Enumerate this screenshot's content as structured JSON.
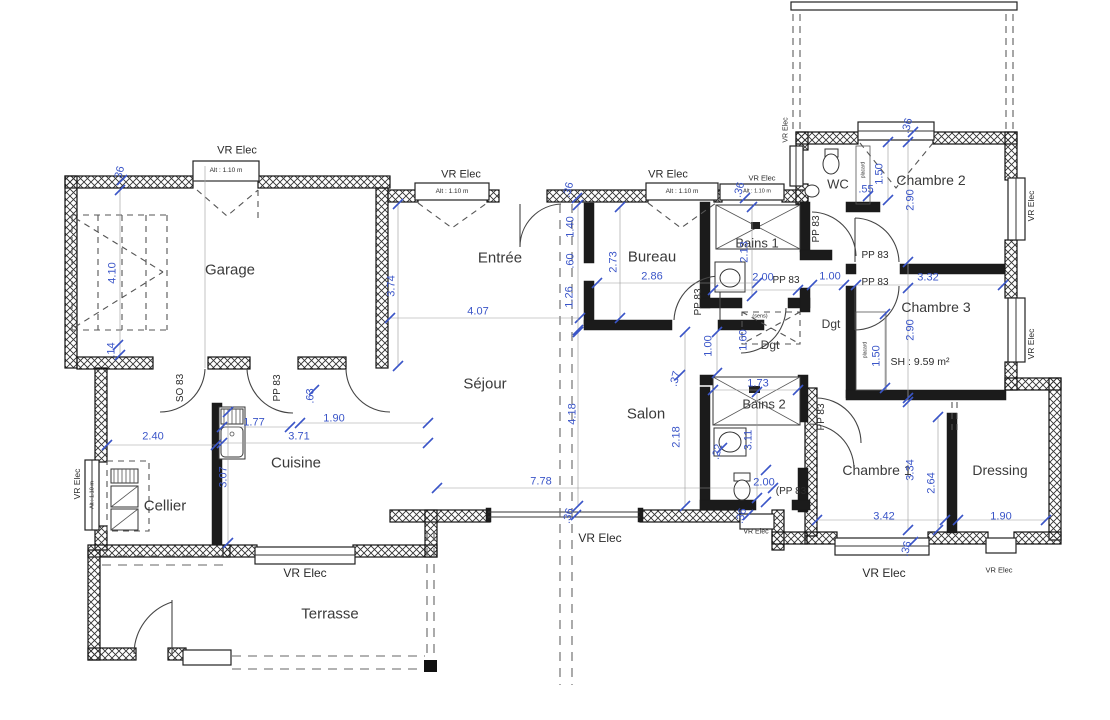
{
  "colors": {
    "dimension": "#3a55c8",
    "wall": "#111111",
    "text": "#3a3a3a",
    "background": "#ffffff"
  },
  "rooms": [
    {
      "label": "Garage",
      "x": 230,
      "y": 270,
      "fs": 15
    },
    {
      "label": "Entrée",
      "x": 500,
      "y": 258,
      "fs": 15
    },
    {
      "label": "Bureau",
      "x": 652,
      "y": 257,
      "fs": 15
    },
    {
      "label": "Séjour",
      "x": 485,
      "y": 384,
      "fs": 15
    },
    {
      "label": "Salon",
      "x": 646,
      "y": 414,
      "fs": 15
    },
    {
      "label": "Cuisine",
      "x": 296,
      "y": 463,
      "fs": 15
    },
    {
      "label": "Cellier",
      "x": 165,
      "y": 506,
      "fs": 15
    },
    {
      "label": "Terrasse",
      "x": 330,
      "y": 614,
      "fs": 15
    },
    {
      "label": "WC",
      "x": 838,
      "y": 184,
      "fs": 13
    },
    {
      "label": "Bains 1",
      "x": 757,
      "y": 243,
      "fs": 13
    },
    {
      "label": "Bains 2",
      "x": 764,
      "y": 404,
      "fs": 13
    },
    {
      "label": "Dgt",
      "x": 770,
      "y": 345,
      "fs": 12
    },
    {
      "label": "Dgt",
      "x": 831,
      "y": 324,
      "fs": 12
    },
    {
      "label": "Chambre 2",
      "x": 931,
      "y": 180,
      "fs": 14
    },
    {
      "label": "Chambre 3",
      "x": 936,
      "y": 307,
      "fs": 14
    },
    {
      "label": "Chambre 1",
      "x": 877,
      "y": 470,
      "fs": 14
    },
    {
      "label": "Dressing",
      "x": 1000,
      "y": 470,
      "fs": 14
    }
  ],
  "dimensions": [
    {
      "label": "4.07",
      "x": 478,
      "y": 312,
      "rot": 0
    },
    {
      "label": "2.86",
      "x": 652,
      "y": 277,
      "rot": 0
    },
    {
      "label": "2.73",
      "x": 614,
      "y": 262,
      "rot": -90
    },
    {
      "label": "1.40",
      "x": 571,
      "y": 227,
      "rot": -90
    },
    {
      "label": ".60",
      "x": 571,
      "y": 261,
      "rot": -90
    },
    {
      "label": "1.26",
      "x": 570,
      "y": 297,
      "rot": -90
    },
    {
      "label": "3.74",
      "x": 392,
      "y": 286,
      "rot": -90
    },
    {
      "label": "4.10",
      "x": 113,
      "y": 273,
      "rot": -90
    },
    {
      "label": ".14",
      "x": 112,
      "y": 350,
      "rot": -90
    },
    {
      "label": ".36",
      "x": 120,
      "y": 174,
      "rot": -75
    },
    {
      "label": ".36",
      "x": 569,
      "y": 190,
      "rot": -75
    },
    {
      "label": ".36",
      "x": 908,
      "y": 126,
      "rot": -75
    },
    {
      "label": ".36",
      "x": 740,
      "y": 190,
      "rot": -75
    },
    {
      "label": ".36",
      "x": 569,
      "y": 516,
      "rot": -75
    },
    {
      "label": ".36",
      "x": 742,
      "y": 516,
      "rot": -75
    },
    {
      "label": ".36",
      "x": 907,
      "y": 549,
      "rot": -75
    },
    {
      "label": "2.13",
      "x": 745,
      "y": 252,
      "rot": -90
    },
    {
      "label": "2.00",
      "x": 763,
      "y": 278,
      "rot": 0
    },
    {
      "label": "1.00",
      "x": 830,
      "y": 277,
      "rot": 0
    },
    {
      "label": "3.32",
      "x": 928,
      "y": 278,
      "rot": 0
    },
    {
      "label": ".55",
      "x": 866,
      "y": 190,
      "rot": 0
    },
    {
      "label": "1.50",
      "x": 880,
      "y": 174,
      "rot": -90
    },
    {
      "label": "2.90",
      "x": 911,
      "y": 200,
      "rot": -90
    },
    {
      "label": "2.90",
      "x": 911,
      "y": 330,
      "rot": -90
    },
    {
      "label": "1.50",
      "x": 877,
      "y": 356,
      "rot": -90
    },
    {
      "label": "1.00",
      "x": 709,
      "y": 346,
      "rot": -90
    },
    {
      "label": "1.60",
      "x": 744,
      "y": 340,
      "rot": -90
    },
    {
      "label": ".37",
      "x": 676,
      "y": 379,
      "rot": -75
    },
    {
      "label": "1.73",
      "x": 758,
      "y": 384,
      "rot": 0
    },
    {
      "label": "2.18",
      "x": 677,
      "y": 437,
      "rot": -90
    },
    {
      "label": "3.11",
      "x": 749,
      "y": 440,
      "rot": -90
    },
    {
      "label": ".22",
      "x": 718,
      "y": 452,
      "rot": -75
    },
    {
      "label": "2.00",
      "x": 764,
      "y": 483,
      "rot": 0
    },
    {
      "label": "4.18",
      "x": 573,
      "y": 414,
      "rot": -90
    },
    {
      "label": "7.78",
      "x": 541,
      "y": 482,
      "rot": 0
    },
    {
      "label": "2.40",
      "x": 153,
      "y": 437,
      "rot": 0
    },
    {
      "label": "1.77",
      "x": 254,
      "y": 423,
      "rot": 0
    },
    {
      "label": "3.71",
      "x": 299,
      "y": 437,
      "rot": 0
    },
    {
      "label": "1.90",
      "x": 334,
      "y": 419,
      "rot": 0
    },
    {
      "label": ".63",
      "x": 311,
      "y": 396,
      "rot": -90
    },
    {
      "label": "3.07",
      "x": 224,
      "y": 477,
      "rot": -90
    },
    {
      "label": "3.34",
      "x": 911,
      "y": 470,
      "rot": -90
    },
    {
      "label": "2.64",
      "x": 932,
      "y": 483,
      "rot": -90
    },
    {
      "label": "3.42",
      "x": 884,
      "y": 517,
      "rot": 0
    },
    {
      "label": "1.90",
      "x": 1001,
      "y": 517,
      "rot": 0
    }
  ],
  "annotations": [
    {
      "label": "VR Elec",
      "x": 237,
      "y": 151,
      "rot": 0,
      "fs": 11
    },
    {
      "label": "Alt : 1.10 m",
      "x": 226,
      "y": 171,
      "rot": 0,
      "fs": 6.5
    },
    {
      "label": "VR Elec",
      "x": 461,
      "y": 175,
      "rot": 0,
      "fs": 11
    },
    {
      "label": "Alt : 1.10 m",
      "x": 452,
      "y": 192,
      "rot": 0,
      "fs": 6.5
    },
    {
      "label": "VR Elec",
      "x": 668,
      "y": 175,
      "rot": 0,
      "fs": 11
    },
    {
      "label": "Alt : 1.10 m",
      "x": 682,
      "y": 192,
      "rot": 0,
      "fs": 6.5
    },
    {
      "label": "VR Elec",
      "x": 762,
      "y": 178,
      "rot": 0,
      "fs": 7.5
    },
    {
      "label": "Alt : 1.10 m",
      "x": 757,
      "y": 192,
      "rot": 0,
      "fs": 5.5
    },
    {
      "label": "VR Elec",
      "x": 786,
      "y": 130,
      "rot": -90,
      "fs": 7
    },
    {
      "label": "VR Elec",
      "x": 1031,
      "y": 206,
      "rot": -90,
      "fs": 8.5
    },
    {
      "label": "VR Elec",
      "x": 1031,
      "y": 344,
      "rot": -90,
      "fs": 8.5
    },
    {
      "label": "VR Elec",
      "x": 600,
      "y": 538,
      "rot": 0,
      "fs": 12
    },
    {
      "label": "VR Elec",
      "x": 756,
      "y": 532,
      "rot": 0,
      "fs": 7
    },
    {
      "label": "VR Elec",
      "x": 884,
      "y": 573,
      "rot": 0,
      "fs": 12
    },
    {
      "label": "VR Elec",
      "x": 999,
      "y": 570,
      "rot": 0,
      "fs": 7.5
    },
    {
      "label": "VR Elec",
      "x": 305,
      "y": 573,
      "rot": 0,
      "fs": 12
    },
    {
      "label": "VR Elec",
      "x": 77,
      "y": 484,
      "rot": -90,
      "fs": 8.5
    },
    {
      "label": "Alt : 1.10 m",
      "x": 93,
      "y": 495,
      "rot": -90,
      "fs": 5.5
    },
    {
      "label": "PP 83",
      "x": 699,
      "y": 302,
      "rot": -90,
      "fs": 10
    },
    {
      "label": "PP 83",
      "x": 817,
      "y": 229,
      "rot": -90,
      "fs": 10
    },
    {
      "label": "PP 83",
      "x": 875,
      "y": 256,
      "rot": 0,
      "fs": 10
    },
    {
      "label": "PP 83",
      "x": 875,
      "y": 283,
      "rot": 0,
      "fs": 10
    },
    {
      "label": "PP 83",
      "x": 786,
      "y": 281,
      "rot": 0,
      "fs": 10
    },
    {
      "label": "(PP 83",
      "x": 791,
      "y": 492,
      "rot": 0,
      "fs": 10
    },
    {
      "label": "PP 83",
      "x": 822,
      "y": 417,
      "rot": -90,
      "fs": 10
    },
    {
      "label": "SO 83",
      "x": 181,
      "y": 388,
      "rot": -90,
      "fs": 10
    },
    {
      "label": "PP 83",
      "x": 278,
      "y": 388,
      "rot": -90,
      "fs": 10
    },
    {
      "label": "SH : 9.59 m²",
      "x": 920,
      "y": 362,
      "rot": 0,
      "fs": 10.5
    },
    {
      "label": "(sens)",
      "x": 760,
      "y": 317,
      "rot": 0,
      "fs": 5.5
    },
    {
      "label": "placard",
      "x": 864,
      "y": 170,
      "rot": -90,
      "fs": 5
    },
    {
      "label": "placard",
      "x": 866,
      "y": 350,
      "rot": -90,
      "fs": 5
    }
  ]
}
